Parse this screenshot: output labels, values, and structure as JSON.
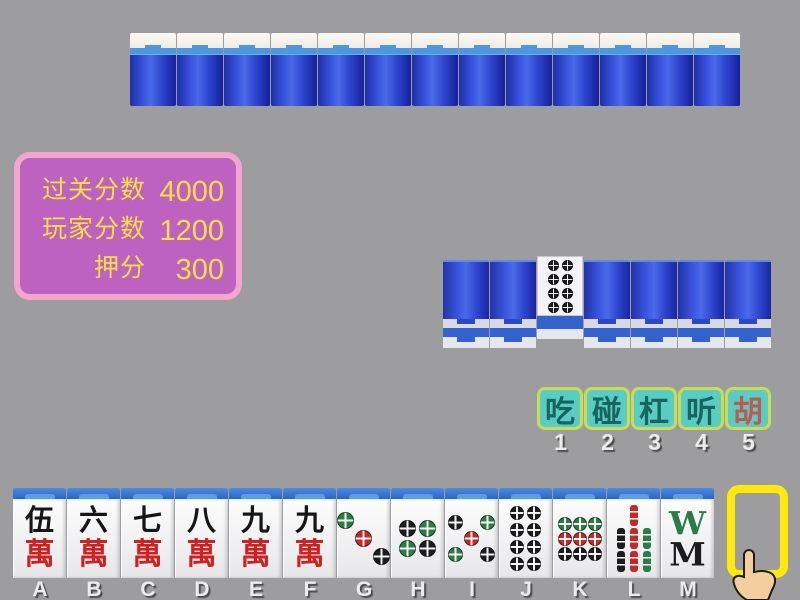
{
  "table": {
    "background": "#9d9da0"
  },
  "score_panel": {
    "fill": "#bd62c1",
    "border_color": "#f2a6ce",
    "text_color": "#ffdf43",
    "rows": [
      {
        "label": "过关分数",
        "value": "4000"
      },
      {
        "label": "玩家分数",
        "value": "1200"
      },
      {
        "label": "押分",
        "value": "300"
      }
    ]
  },
  "opponent_hand": {
    "tile_count": 13
  },
  "middle_row": {
    "tiles": [
      {
        "face": "down"
      },
      {
        "face": "down"
      },
      {
        "face": "up",
        "suit": "dots",
        "value": 8
      },
      {
        "face": "down"
      },
      {
        "face": "down"
      },
      {
        "face": "down"
      },
      {
        "face": "down"
      }
    ]
  },
  "action_bar": {
    "bg": "#5accc4",
    "border_color": "#c9dc55",
    "buttons": [
      {
        "label": "吃",
        "key": "1",
        "text_color": "#17655f"
      },
      {
        "label": "碰",
        "key": "2",
        "text_color": "#17655f"
      },
      {
        "label": "杠",
        "key": "3",
        "text_color": "#17655f"
      },
      {
        "label": "听",
        "key": "4",
        "text_color": "#17655f"
      },
      {
        "label": "胡",
        "key": "5",
        "text_color": "#c05a50"
      }
    ]
  },
  "player_hand": {
    "tiles": [
      {
        "slot": "A",
        "suit": "wan",
        "char": "伍",
        "value": 5
      },
      {
        "slot": "B",
        "suit": "wan",
        "char": "六",
        "value": 6
      },
      {
        "slot": "C",
        "suit": "wan",
        "char": "七",
        "value": 7
      },
      {
        "slot": "D",
        "suit": "wan",
        "char": "八",
        "value": 8
      },
      {
        "slot": "E",
        "suit": "wan",
        "char": "九",
        "value": 9
      },
      {
        "slot": "F",
        "suit": "wan",
        "char": "九",
        "value": 9
      },
      {
        "slot": "G",
        "suit": "dots",
        "value": 3
      },
      {
        "slot": "H",
        "suit": "dots",
        "value": 4
      },
      {
        "slot": "I",
        "suit": "dots",
        "value": 5
      },
      {
        "slot": "J",
        "suit": "dots",
        "value": 8
      },
      {
        "slot": "K",
        "suit": "dots",
        "value": 9
      },
      {
        "slot": "L",
        "suit": "bamboo",
        "value": 7
      },
      {
        "slot": "M",
        "suit": "bamboo",
        "value": 8
      }
    ],
    "draw_slot": {
      "slot": "N",
      "label_color": "#f2c94c",
      "border_color": "#ffe90a"
    }
  },
  "tile_defs": {
    "wan_bottom_char": "萬",
    "suit_colors": {
      "green": "#2a7d45",
      "red": "#c22a2a",
      "black": "#1c1c1c"
    },
    "dot_layouts": {
      "3": {
        "rows": 3,
        "cols": 3,
        "cells": [
          [
            0,
            0,
            "green"
          ],
          [
            1,
            1,
            "red"
          ],
          [
            2,
            2,
            "black"
          ]
        ]
      },
      "4": {
        "rows": 2,
        "cols": 2,
        "cells": [
          [
            0,
            0,
            "black"
          ],
          [
            0,
            1,
            "green"
          ],
          [
            1,
            0,
            "green"
          ],
          [
            1,
            1,
            "black"
          ]
        ]
      },
      "5": {
        "rows": 3,
        "cols": 3,
        "cells": [
          [
            0,
            0,
            "black"
          ],
          [
            0,
            2,
            "green"
          ],
          [
            1,
            1,
            "red"
          ],
          [
            2,
            0,
            "green"
          ],
          [
            2,
            2,
            "black"
          ]
        ]
      },
      "8": {
        "rows": 4,
        "cols": 2,
        "cells": [
          [
            0,
            0,
            "black"
          ],
          [
            0,
            1,
            "black"
          ],
          [
            1,
            0,
            "black"
          ],
          [
            1,
            1,
            "black"
          ],
          [
            2,
            0,
            "black"
          ],
          [
            2,
            1,
            "black"
          ],
          [
            3,
            0,
            "black"
          ],
          [
            3,
            1,
            "black"
          ]
        ]
      },
      "9": {
        "rows": 3,
        "cols": 3,
        "cells": [
          [
            0,
            0,
            "green"
          ],
          [
            0,
            1,
            "green"
          ],
          [
            0,
            2,
            "green"
          ],
          [
            1,
            0,
            "red"
          ],
          [
            1,
            1,
            "red"
          ],
          [
            1,
            2,
            "red"
          ],
          [
            2,
            0,
            "black"
          ],
          [
            2,
            1,
            "black"
          ],
          [
            2,
            2,
            "black"
          ]
        ]
      }
    },
    "bamboo_layouts": {
      "7": {
        "rows": [
          [
            null,
            "red",
            null
          ],
          [
            "black",
            "red",
            "green"
          ],
          [
            "black",
            "red",
            "green"
          ]
        ]
      },
      "8": {
        "glyphs": [
          {
            "char": "W",
            "color": "green"
          },
          {
            "char": "M",
            "color": "black"
          }
        ]
      }
    }
  },
  "cursor": {
    "type": "pointing-hand",
    "skin": "#f4cf9e",
    "outline": "#1c1c1c"
  }
}
